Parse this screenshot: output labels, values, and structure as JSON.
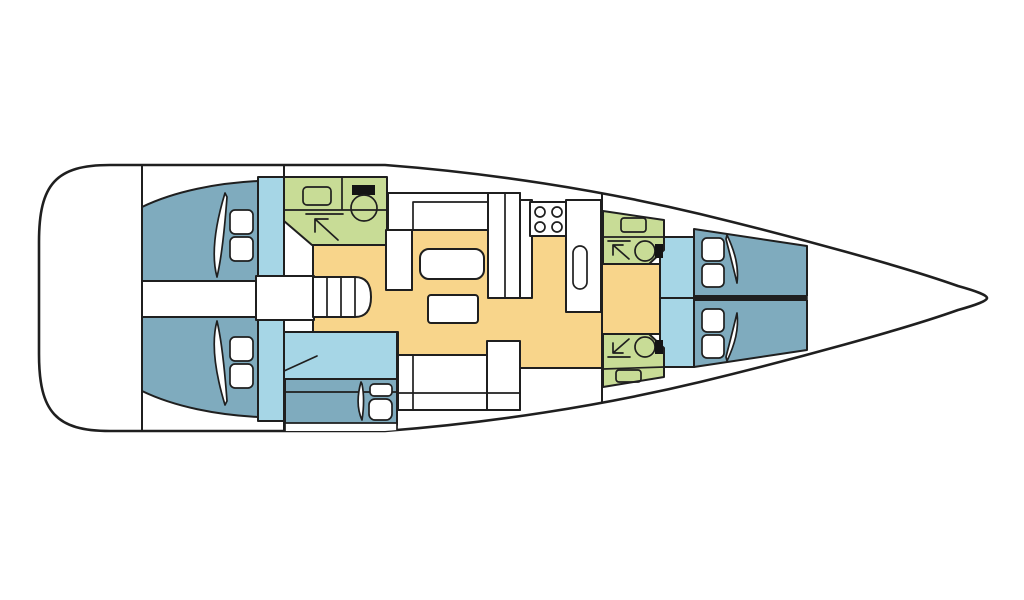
{
  "diagram": {
    "type": "floorplan",
    "subject": "sailing yacht interior layout, top view",
    "orientation": {
      "bow": "right",
      "stern": "left"
    },
    "colors": {
      "background": "#ffffff",
      "outline": "#1f1f1f",
      "hull_fill": "#ffffff",
      "bed": "#7fabbe",
      "cabin_floor": "#a6d6e6",
      "head_compartment": "#c8dc96",
      "saloon_floor": "#f8d58b",
      "furniture": "#ffffff",
      "toilet_tank": "#141414"
    },
    "rooms": [
      {
        "id": "stern-platform",
        "label": "stern platform"
      },
      {
        "id": "aft-cabin-port",
        "label": "aft double cabin, port"
      },
      {
        "id": "aft-cabin-starboard",
        "label": "aft double cabin, starboard"
      },
      {
        "id": "aft-head",
        "label": "aft head with sink, toilet and shower"
      },
      {
        "id": "companionway",
        "label": "companionway with stairs"
      },
      {
        "id": "saloon",
        "label": "saloon with two tables and settees"
      },
      {
        "id": "skipper-berth",
        "label": "lower berth cabin"
      },
      {
        "id": "galley",
        "label": "galley with stove and sink"
      },
      {
        "id": "forward-head-port",
        "label": "forward head, port"
      },
      {
        "id": "forward-head-starboard",
        "label": "forward head, starboard"
      },
      {
        "id": "forward-cabin-port",
        "label": "forward V-berth cabin, port"
      },
      {
        "id": "forward-cabin-starboard",
        "label": "forward V-berth cabin, starboard"
      },
      {
        "id": "bow",
        "label": "bow"
      }
    ],
    "fixtures": {
      "beds": 5,
      "pillows": 10,
      "stair_treads": 4,
      "stove_burners": 4,
      "toilets": 3,
      "sinks_bathroom": 3,
      "sink_galley": 1,
      "shower_arrows": 3,
      "tables": 2
    },
    "icons": [
      "bed-pillow-icon",
      "blanket-fold-icon",
      "sink-icon",
      "toilet-icon",
      "shower-arrow-icon",
      "stove-burners-icon",
      "stairs-icon",
      "table-icon"
    ]
  }
}
